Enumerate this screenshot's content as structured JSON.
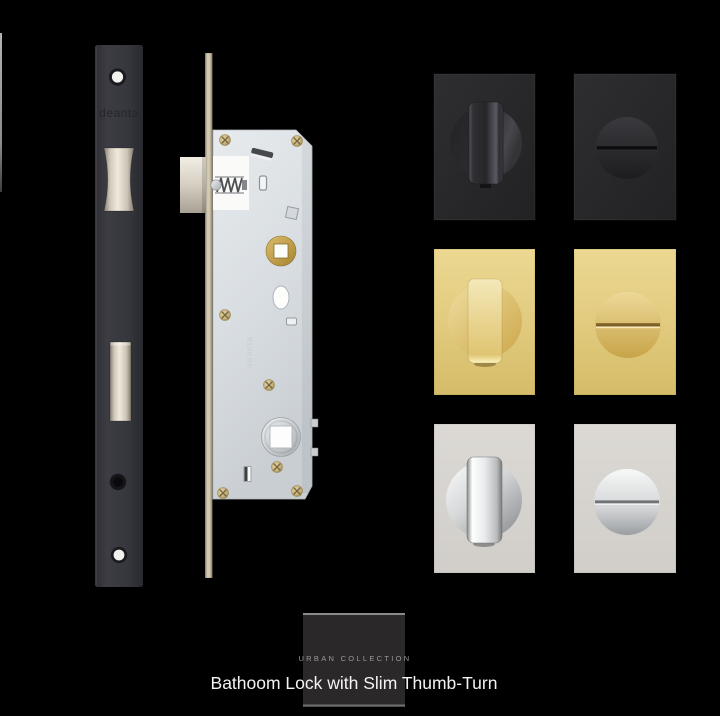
{
  "scene": {
    "background_hex": "#000000"
  },
  "faceplate": {
    "brand_text": "deanta",
    "finish_hex": "#36363c",
    "bolt_hex": "#e9e2d4"
  },
  "lock_case": {
    "brand_text": "deanta",
    "body_hex": "#d9dde1",
    "forend_hex": "#cfc5ae",
    "brass_follower_hex": "#c29c4b",
    "steel_follower_hex": "#d2d6da",
    "screw_hex": "#c3ad76"
  },
  "thumb_turn_grid": {
    "finishes": [
      {
        "id": "matt-black",
        "plate_hex": "#29292b",
        "knob_hex": "#2e2e32"
      },
      {
        "id": "satin-brass",
        "plate_hex": "#e2cb80",
        "knob_hex": "#e8d491"
      },
      {
        "id": "polished-chrome",
        "plate_hex": "#d8d5d0",
        "knob_hex": "#e3e5e6"
      }
    ],
    "variants": [
      "thumb-turn-front",
      "coin-release-back"
    ]
  },
  "badge": {
    "label": "URBAN COLLECTION",
    "background_hex": "#2b282a",
    "text_hex": "#9a9a9a",
    "rule_hex": "#7d7d7d"
  },
  "caption": {
    "text": "Bathoom Lock with Slim Thumb-Turn",
    "text_hex": "#f3f3f3"
  }
}
